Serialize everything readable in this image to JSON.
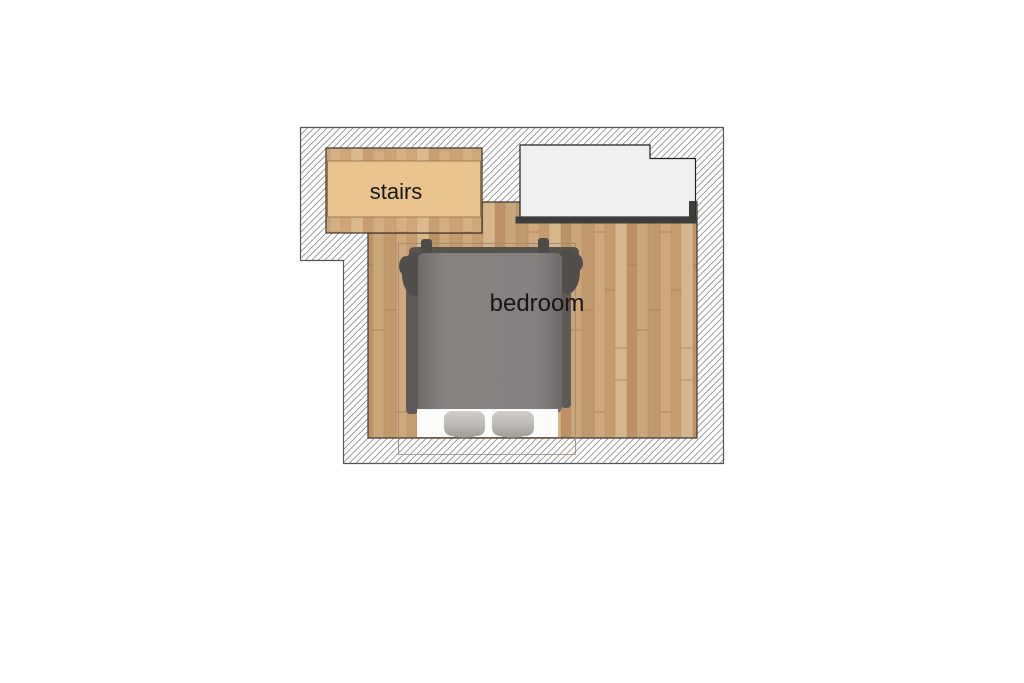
{
  "floorplan": {
    "labels": {
      "stairs": "stairs",
      "bedroom": "bedroom"
    },
    "colors": {
      "wall_hatch_line": "#8f8f8f",
      "wall_border": "#555555",
      "floor_wood_base": "#c8a478",
      "floor_edge_line": "#41352a",
      "stairs_fill": "#eac48f",
      "upper_area_fill": "#f0efed",
      "upper_area_accent": "#3d3d3d",
      "bed_duvet": "#817d7a",
      "bed_frame_dark": "#56524e",
      "pillow_fill": "#c3bfba",
      "sheet_fill": "#fbfbfa",
      "room_outline": "#9b8a72",
      "label_color": "#181512"
    }
  }
}
